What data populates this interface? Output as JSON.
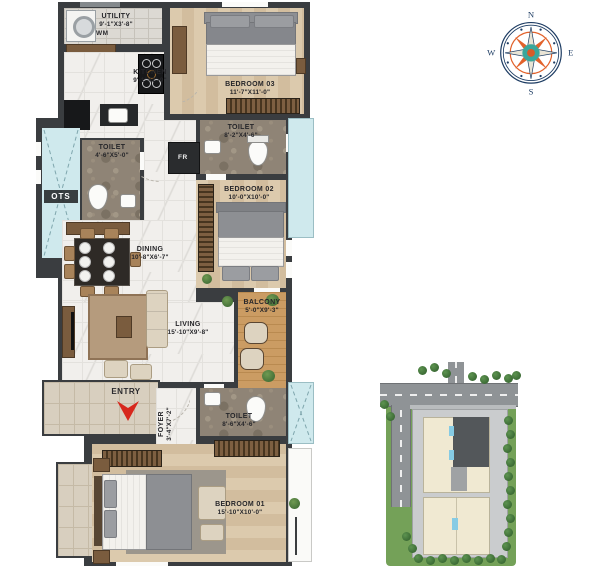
{
  "plan": {
    "rooms": {
      "utility": {
        "label": "UTILITY",
        "dims": "9'-1\"X3'-8\""
      },
      "kitchen": {
        "label": "KITCHEN",
        "dims": "9'-1\"X7'-9\""
      },
      "bedroom3": {
        "label": "BEDROOM 03",
        "dims": "11'-7\"X11'-0\""
      },
      "toilet_b3": {
        "label": "TOILET",
        "dims": "8'-2\"X4'-6\""
      },
      "toilet_common": {
        "label": "TOILET",
        "dims": "4'-6\"X5'-0\""
      },
      "bedroom2": {
        "label": "BEDROOM 02",
        "dims": "10'-0\"X10'-0\""
      },
      "dining": {
        "label": "DINING",
        "dims": "10'-8\"X6'-7\""
      },
      "living": {
        "label": "LIVING",
        "dims": "15'-10\"X9'-8\""
      },
      "balcony": {
        "label": "BALCONY",
        "dims": "5'-0\"X9'-3\""
      },
      "foyer": {
        "label": "FOYER",
        "dims": "3'-4\"X7'-2\""
      },
      "toilet_b1": {
        "label": "TOILET",
        "dims": "8'-6\"X4'-6\""
      },
      "bedroom1": {
        "label": "BEDROOM 01",
        "dims": "15'-10\"X10'-0\""
      }
    },
    "markers": {
      "entry": "ENTRY",
      "ots": "OTS",
      "wm": "WM",
      "fr": "FR"
    }
  },
  "compass": {
    "north": "N",
    "east": "E",
    "south": "S",
    "west": "W"
  },
  "colors": {
    "wall": "#3a3d40",
    "entry_arrow": "#d7281d",
    "ots_shaft": "#cfe9ed",
    "lawn": "#74a158",
    "road": "#8f9396",
    "building": "#f0e9d2",
    "highlight_unit": "#53575a",
    "compass_navy": "#1d3c63",
    "compass_orange": "#e2622b",
    "compass_teal": "#3aa79b"
  }
}
